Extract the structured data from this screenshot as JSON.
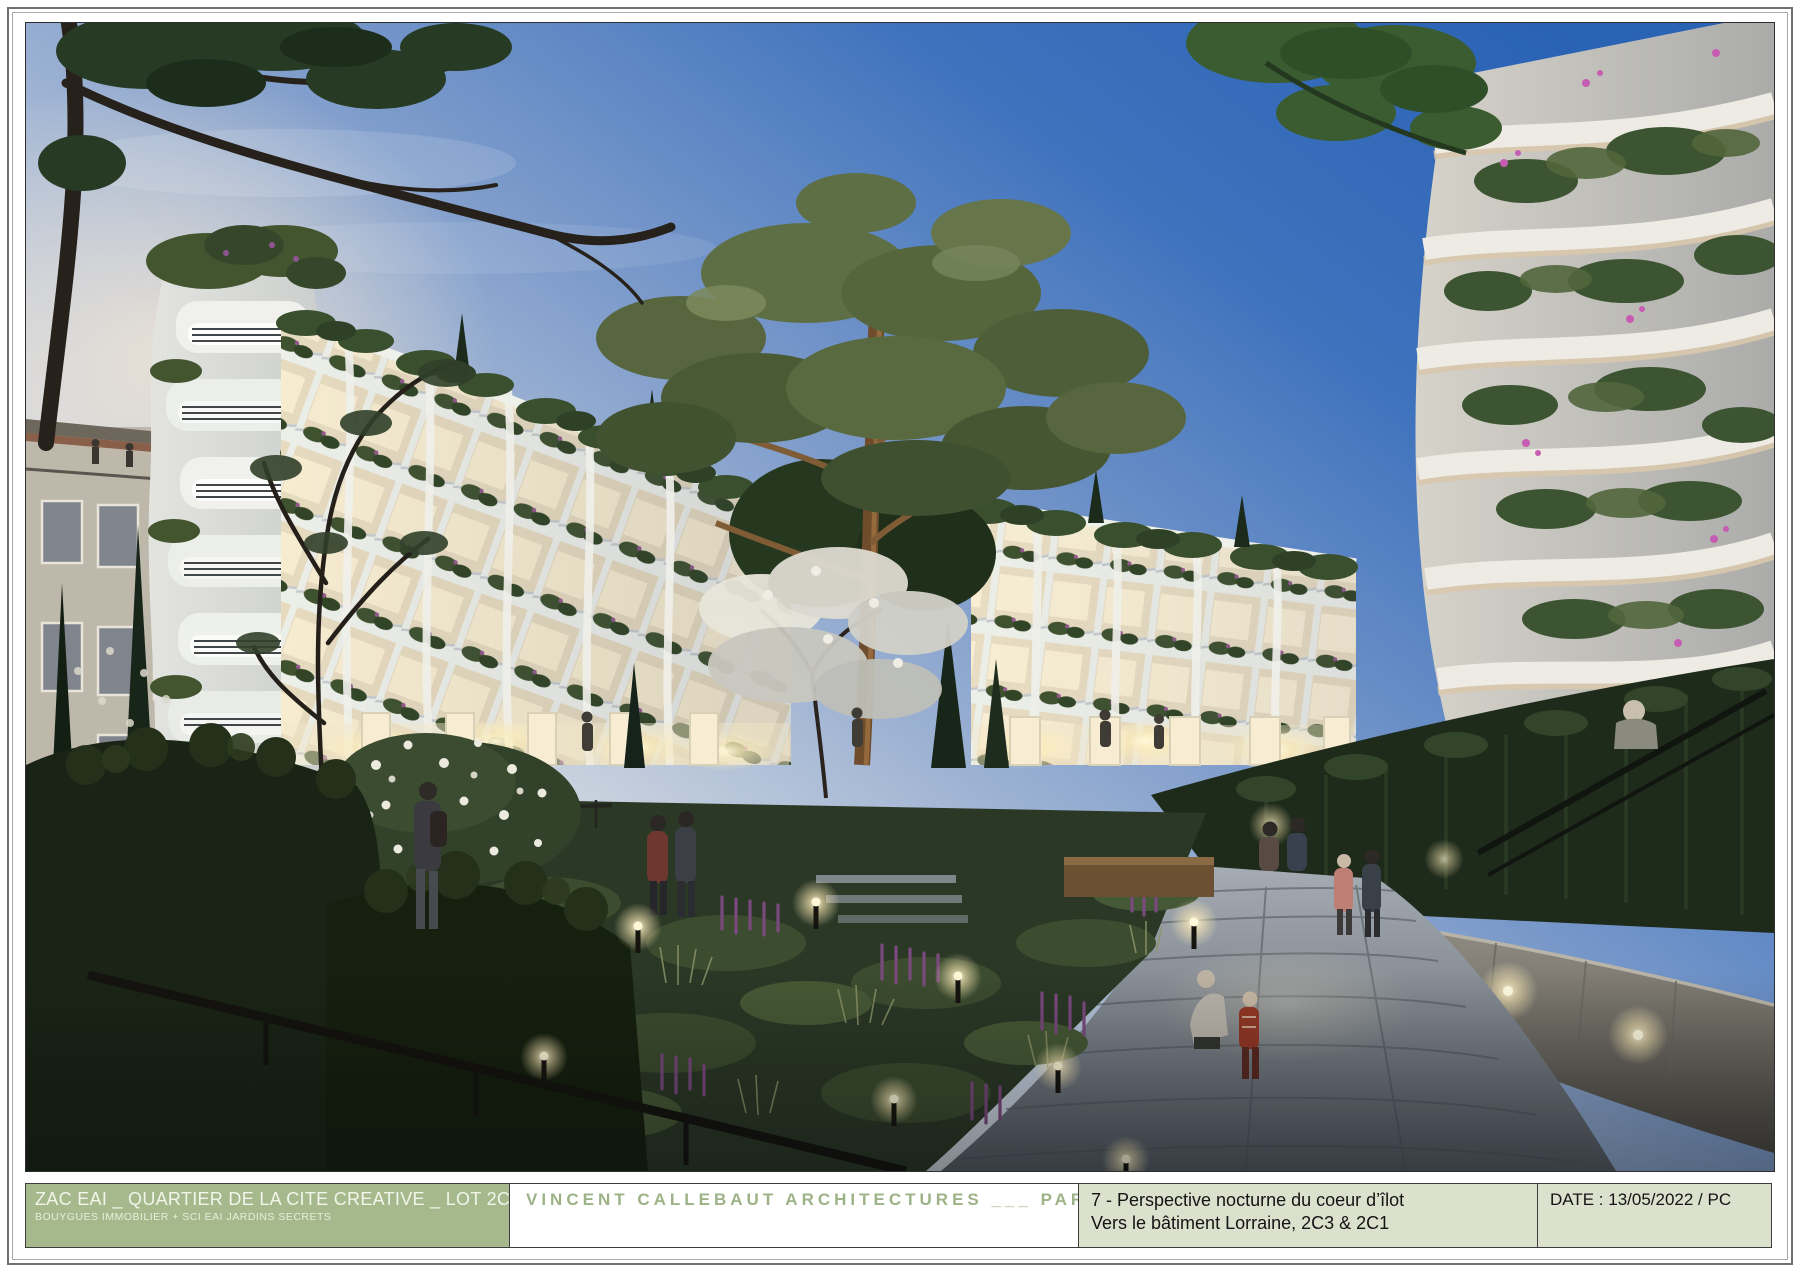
{
  "title_block": {
    "project": {
      "line1": "ZAC EAI _ QUARTIER DE LA CITE CREATIVE _ LOT 2C",
      "line2": "BOUYGUES IMMOBILIER + SCI EAI JARDINS SECRETS",
      "bg_color": "#a6b98c",
      "text_color": "#f2f5ea"
    },
    "architect": {
      "name": "VINCENT CALLEBAUT ARCHITECTURES ___ PARIS",
      "text_color": "#9db387",
      "bg_color": "#ffffff"
    },
    "drawing": {
      "line1": "7 - Perspective nocturne du coeur d’îlot",
      "line2": "Vers le bâtiment Lorraine, 2C3 & 2C1",
      "bg_color": "#dce1cd",
      "text_color": "#141414"
    },
    "date": {
      "label": "DATE : 13/05/2022 / PC",
      "bg_color": "#dce1cd",
      "text_color": "#141414"
    }
  },
  "rendering": {
    "description": "Night-time perspective of a landscaped courtyard: white organic-balcony residential buildings with warm lit interiors and dense planting, a tall pine tree, a stone path with garden lights, ivy-covered wall and residents strolling.",
    "palette": {
      "sky_deep_blue": "#2a62b4",
      "sky_pale_dusk": "#eae4d9",
      "facade_white": "#edeee9",
      "window_glow": "#f7ecd0",
      "foliage_dark": "#24341f",
      "foliage_mid": "#4c5c36",
      "flower_purple": "#8f5590",
      "bougainvillea_pink": "#c75db2",
      "stone_path": "#7d858e",
      "stone_wall": "#6e6a62"
    }
  }
}
